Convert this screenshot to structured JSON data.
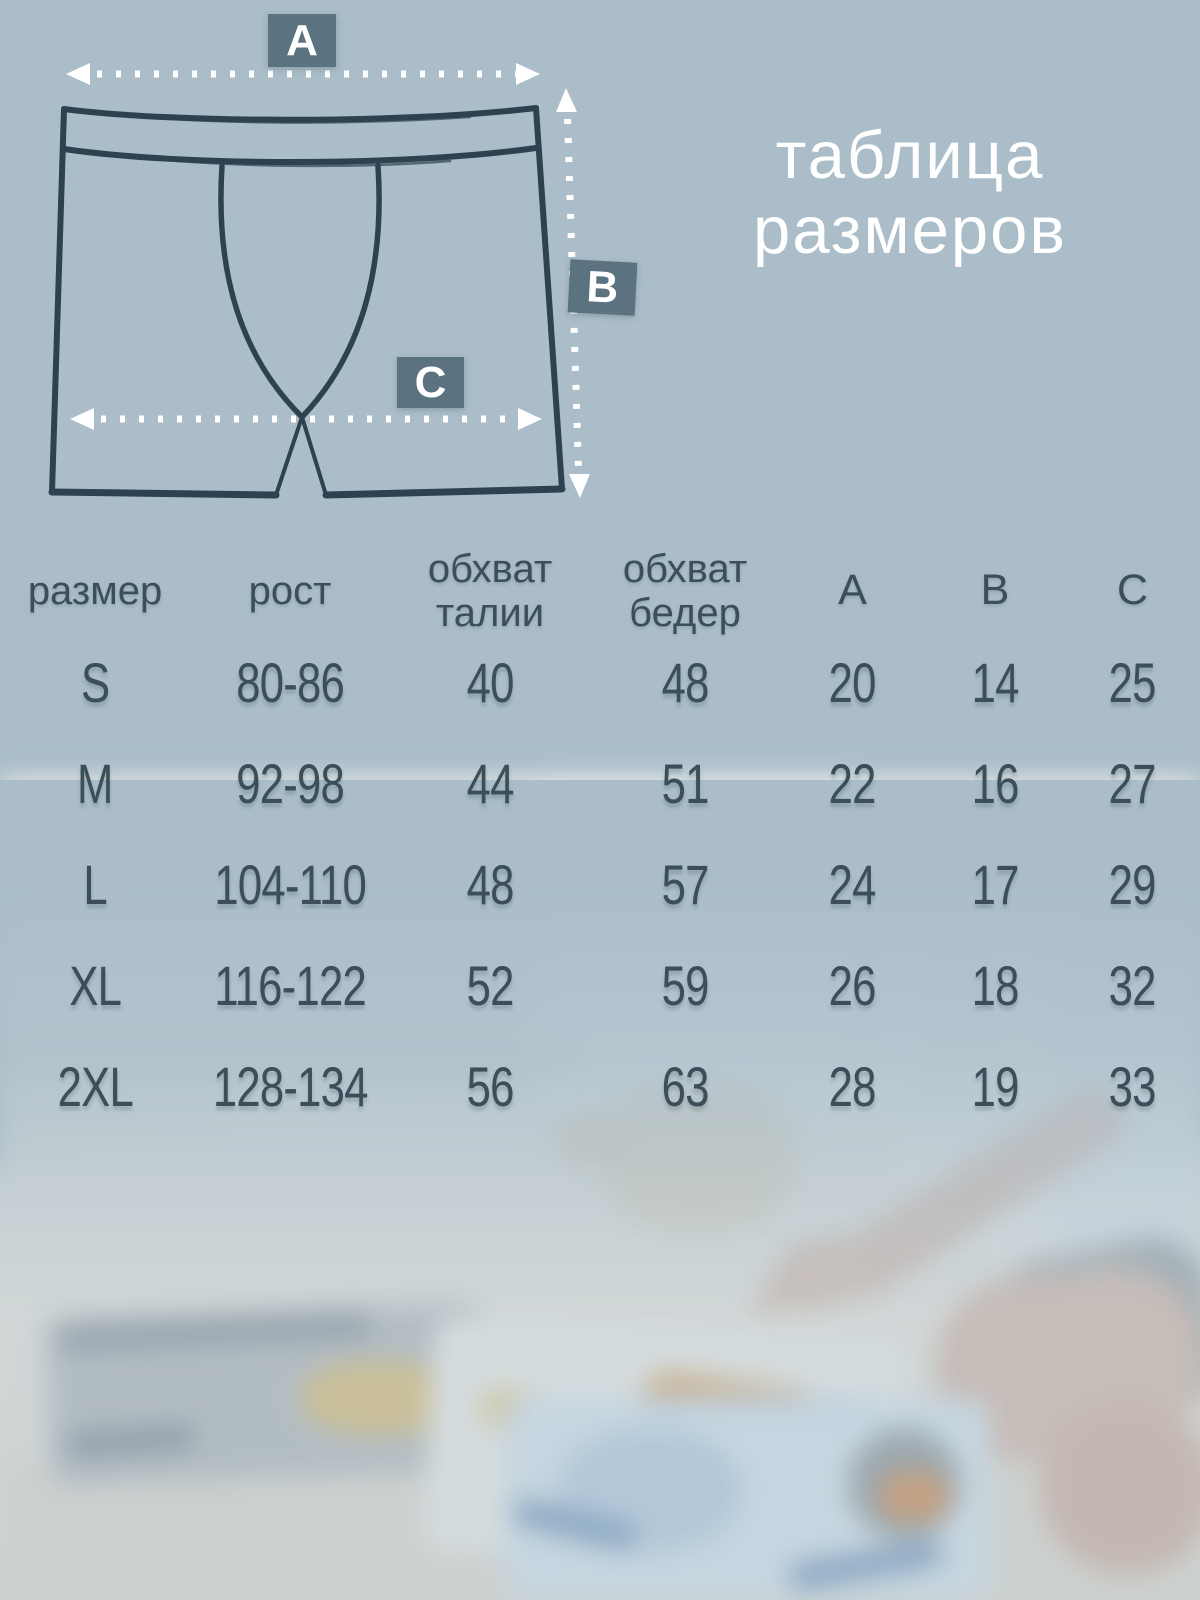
{
  "title": {
    "line1": "таблица",
    "line2": "размеров"
  },
  "diagram": {
    "labels": {
      "a": "A",
      "b": "B",
      "c": "C"
    },
    "description": "hand-drawn boxer shorts with measurement arrows A (waist width), B (side length), C (hip width)"
  },
  "size_table": {
    "header": {
      "size": "размер",
      "height": "рост",
      "waist_line1": "обхват",
      "waist_line2": "талии",
      "hips_line1": "обхват",
      "hips_line2": "бедер",
      "a": "A",
      "b": "B",
      "c": "C"
    },
    "rows": [
      {
        "size": "S",
        "height": "80-86",
        "waist": "40",
        "hips": "48",
        "a": "20",
        "b": "14",
        "c": "25"
      },
      {
        "size": "M",
        "height": "92-98",
        "waist": "44",
        "hips": "51",
        "a": "22",
        "b": "16",
        "c": "27"
      },
      {
        "size": "L",
        "height": "104-110",
        "waist": "48",
        "hips": "57",
        "a": "24",
        "b": "17",
        "c": "29"
      },
      {
        "size": "XL",
        "height": "116-122",
        "waist": "52",
        "hips": "59",
        "a": "26",
        "b": "18",
        "c": "32"
      },
      {
        "size": "2XL",
        "height": "128-134",
        "waist": "56",
        "hips": "63",
        "a": "28",
        "b": "19",
        "c": "33"
      }
    ]
  },
  "chart_data": {
    "type": "table",
    "title": "таблица размеров",
    "columns": [
      "размер",
      "рост",
      "обхват талии",
      "обхват бедер",
      "A",
      "B",
      "C"
    ],
    "rows": [
      [
        "S",
        "80-86",
        40,
        48,
        20,
        14,
        25
      ],
      [
        "M",
        "92-98",
        44,
        51,
        22,
        16,
        27
      ],
      [
        "L",
        "104-110",
        48,
        57,
        24,
        17,
        29
      ],
      [
        "XL",
        "116-122",
        52,
        59,
        26,
        18,
        32
      ],
      [
        "2XL",
        "128-134",
        56,
        63,
        28,
        19,
        33
      ]
    ]
  },
  "colors": {
    "background": "#aabdc9",
    "label_square": "#5b7280",
    "ink": "#2e4150",
    "table_text": "#3c4e59",
    "title_text": "#ffffff"
  }
}
